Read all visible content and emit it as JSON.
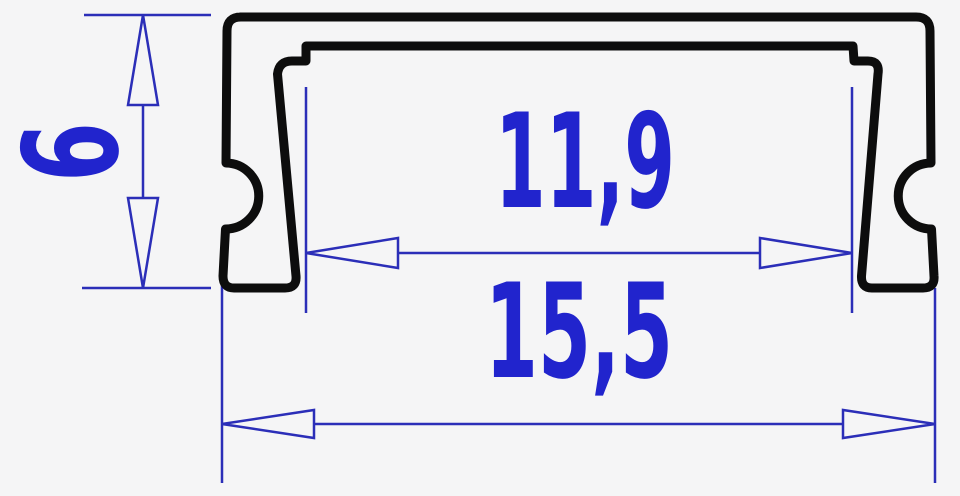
{
  "diagram": {
    "type": "technical-drawing",
    "subject": "profile-cross-section",
    "background_color": "#f5f5f6",
    "outline_color": "#0d0d0d",
    "dimension_line_color": "#2b2eb8",
    "label_color": "#2124cd",
    "dimensions": {
      "height": {
        "value": "6",
        "orientation": "vertical"
      },
      "inner_width": {
        "value": "11,9",
        "orientation": "horizontal"
      },
      "outer_width": {
        "value": "15,5",
        "orientation": "horizontal"
      }
    }
  }
}
